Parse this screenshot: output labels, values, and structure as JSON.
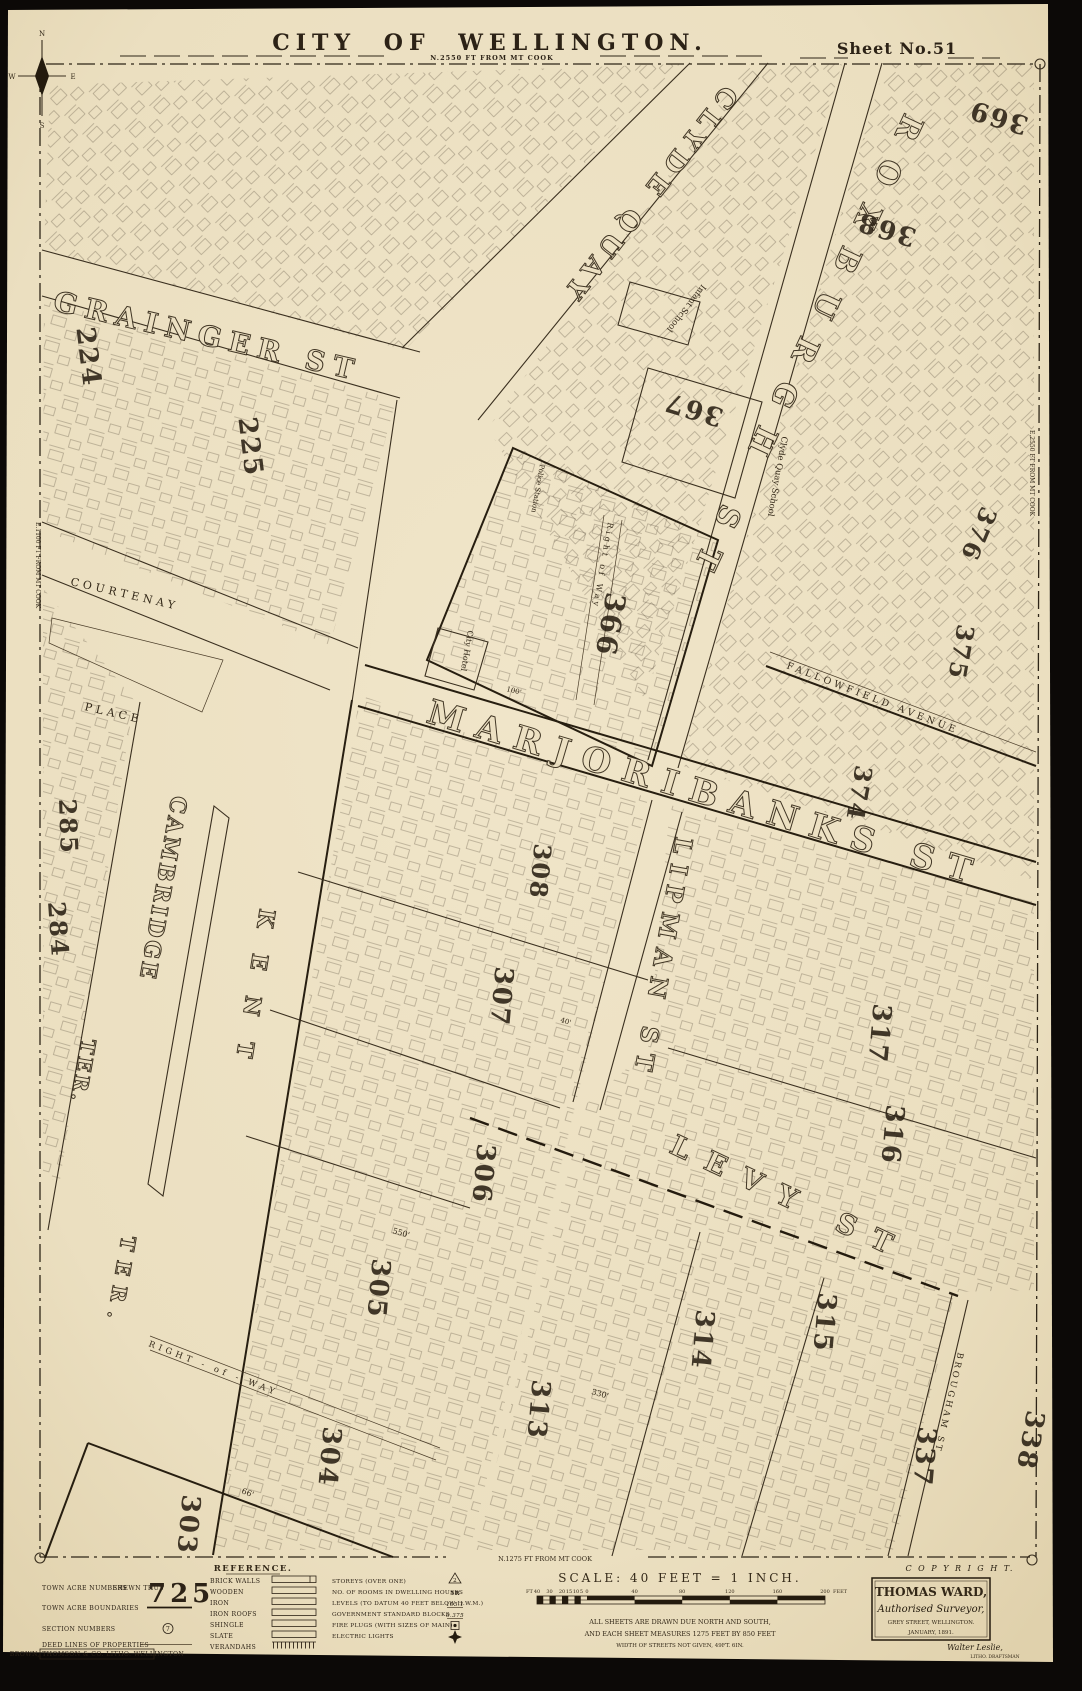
{
  "page": {
    "title": "CITY  OF  WELLINGTON.",
    "subtitle": "N.2550 FT FROM MT COOK",
    "sheet_label": "Sheet No.51"
  },
  "edge_notes": {
    "left": "E.1100 FT FROM MT COOK",
    "right": "E.2550 FT FROM MT COOK",
    "bottom": "N.1275 FT FROM MT COOK"
  },
  "compass": {
    "n": "N",
    "s": "S",
    "e": "E",
    "w": "W"
  },
  "streets": [
    {
      "name": "grainger-st",
      "label": "GRAINGER ST"
    },
    {
      "name": "clyde-quay",
      "label": "CLYDE QUAY"
    },
    {
      "name": "roxburgh-st",
      "label": "ROXBURGH ST"
    },
    {
      "name": "marjoribanks-st",
      "label": "MARJORIBANKS ST"
    },
    {
      "name": "lipman-st",
      "label": "LIPMAN ST"
    },
    {
      "name": "levy-st",
      "label": "LEVY ST"
    },
    {
      "name": "cambridge-ter",
      "label": "CAMBRIDGE",
      "suffix": "TER."
    },
    {
      "name": "kent-ter",
      "label": "KENT",
      "suffix": "TER."
    },
    {
      "name": "courtenay-place",
      "label": "COURTENAY",
      "suffix": "PLACE"
    },
    {
      "name": "fallowfield-avenue",
      "label": "FALLOWFIELD  AVENUE"
    },
    {
      "name": "brougham-st",
      "label": "BROUGHAM ST"
    },
    {
      "name": "right-of-way-south",
      "label": "RIGHT - of - WAY"
    },
    {
      "name": "right-of-way-366",
      "label": "Right of Way"
    }
  ],
  "acres": [
    "224",
    "225",
    "284",
    "285",
    "303",
    "304",
    "305",
    "306",
    "307",
    "308",
    "313",
    "314",
    "315",
    "316",
    "317",
    "337",
    "338",
    "366",
    "367",
    "368",
    "369",
    "374",
    "375",
    "376"
  ],
  "landmarks": [
    {
      "label": "Infant School"
    },
    {
      "label": "Clyde Quay School"
    },
    {
      "label": "City Hotel"
    },
    {
      "label": "Police Station"
    }
  ],
  "dimensions": [
    "550'",
    "330'",
    "66'",
    "100'",
    "40'"
  ],
  "reference": {
    "heading": "REFERENCE.",
    "left": [
      {
        "label": "TOWN ACRE NUMBERS",
        "note": "SHEWN THUS",
        "sample": "725"
      },
      {
        "label": "TOWN ACRE BOUNDARIES"
      },
      {
        "label": "SECTION NUMBERS",
        "sample": "7"
      },
      {
        "label": "DEED LINES OF PROPERTIES"
      },
      {
        "label": "BROWN, THOMSON & CO. LITHO. WELLINGTON"
      }
    ],
    "materials": [
      {
        "label": "BRICK WALLS"
      },
      {
        "label": "WOODEN"
      },
      {
        "label": "IRON"
      },
      {
        "label": "IRON ROOFS"
      },
      {
        "label": "SHINGLE"
      },
      {
        "label": "SLATE"
      },
      {
        "label": "VERANDAHS"
      }
    ],
    "symbols": [
      {
        "label": "STOREYS (OVER ONE)",
        "symbol": "2"
      },
      {
        "label": "NO. OF ROOMS IN DWELLING HOUSES",
        "symbol": "5R"
      },
      {
        "label": "LEVELS (TO DATUM 40 FEET BELOW H.W.M.)",
        "symbol": "105.1"
      },
      {
        "label": "GOVERNMENT STANDARD BLOCKS",
        "symbol": "0.375"
      },
      {
        "label": "FIRE PLUGS (WITH SIZES OF MAIN)",
        "symbol": ""
      },
      {
        "label": "ELECTRIC LIGHTS",
        "symbol": ""
      }
    ]
  },
  "scale": {
    "heading": "SCALE: 40 FEET = 1 INCH.",
    "unit_prefix": "FT",
    "left_ticks": [
      "40",
      "30",
      "20",
      "15",
      "10",
      "5",
      "0"
    ],
    "main_ticks": [
      "40",
      "80",
      "120",
      "160",
      "200"
    ],
    "unit_suffix": "FEET",
    "notes": [
      "ALL SHEETS ARE DRAWN DUE NORTH AND SOUTH,",
      "AND EACH SHEET MEASURES 1275 FEET BY 850 FEET",
      "WIDTH OF STREETS NOT GIVEN, 49FT. 6IN."
    ]
  },
  "imprint": {
    "copyright": "C O P Y R I G H T.",
    "surveyor_name": "THOMAS WARD,",
    "surveyor_title": "Authorised Surveyor,",
    "address": "GREY STREET, WELLINGTON.",
    "date": "JANUARY, 1891.",
    "draftsman": "Walter Leslie,",
    "draftsman_title": "LITHO. DRAFTSMAN"
  }
}
